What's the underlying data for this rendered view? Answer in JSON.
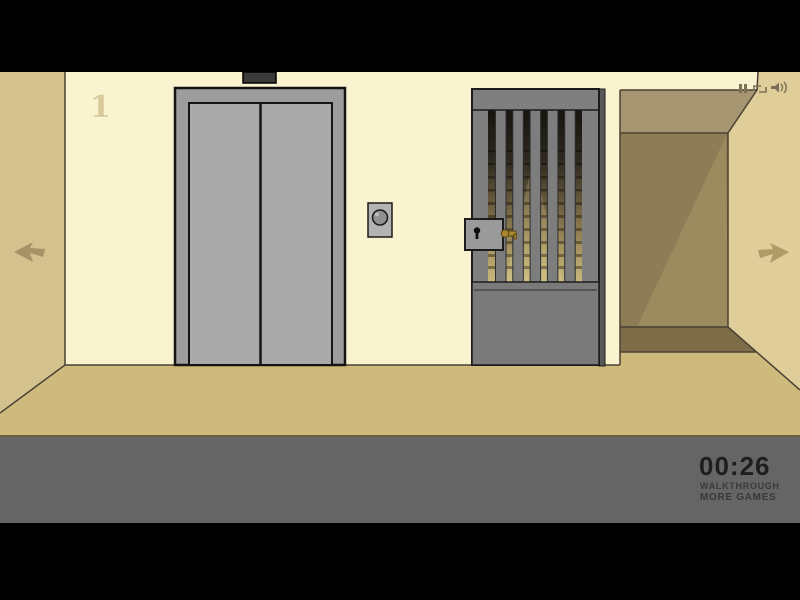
{
  "hud": {
    "timer": "00:26",
    "walkthrough_label": "WALKTHROUGH",
    "more_games_label": "MORE GAMES"
  },
  "scene": {
    "floor_number": "1",
    "icons": [
      "pause-icon",
      "quality-icon",
      "sound-icon",
      "nav-arrow-left-icon",
      "nav-arrow-right-icon"
    ]
  },
  "colors": {
    "wall_front": "#faf3cf",
    "wall_left": "#d3c18e",
    "wall_right": "#dfcd9a",
    "floor": "#cfba7d",
    "corridor_dark": "#8d7c55",
    "ui_band": "#656565",
    "elevator_door": "#a9a9a9",
    "gate_gray": "#7f7f7f",
    "key_brass": "#a8872f",
    "timer_text": "#1e1e1e"
  }
}
